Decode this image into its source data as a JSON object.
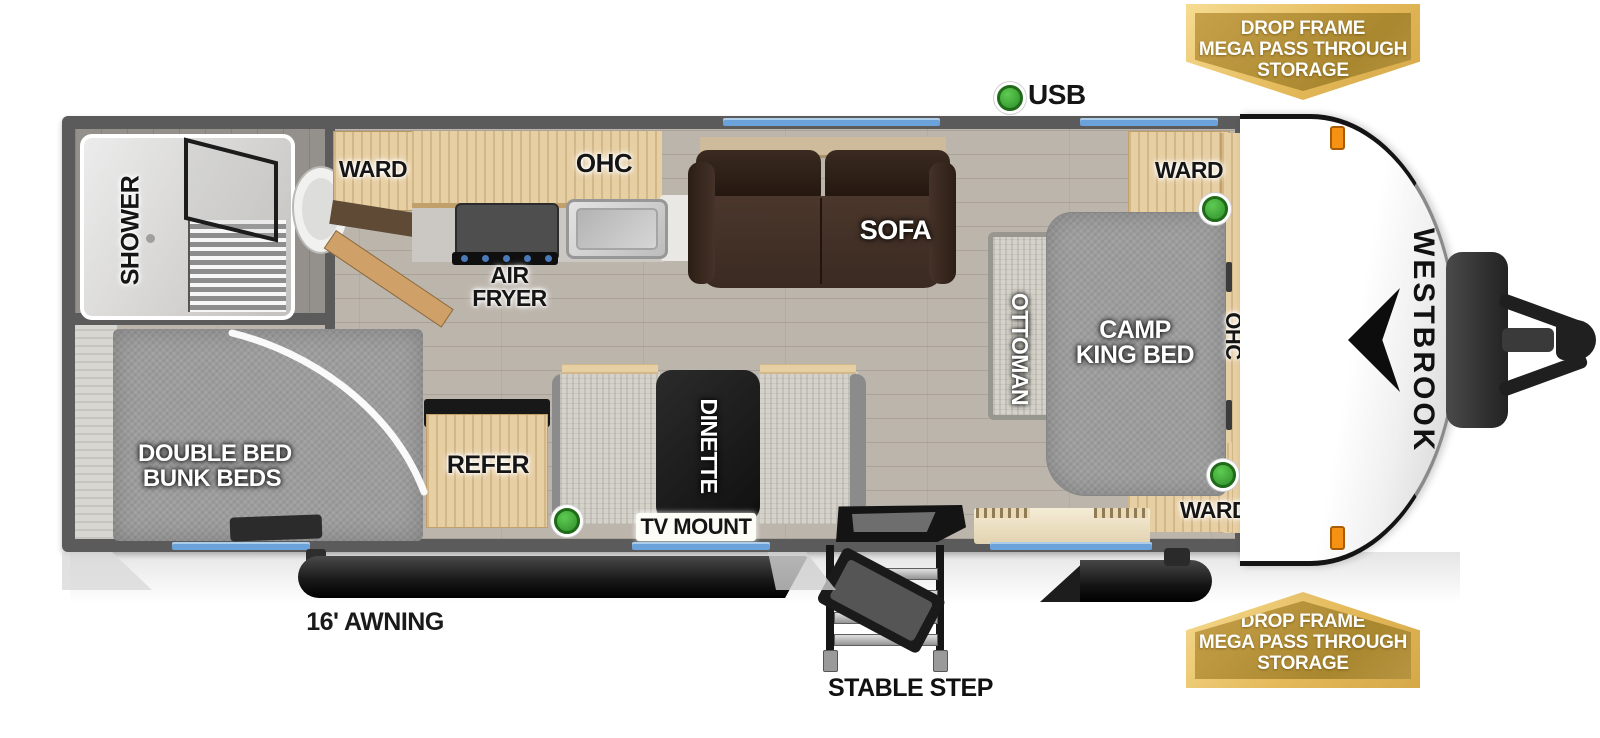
{
  "title": "Westbrook travel trailer floor plan",
  "brand": "WESTBROOK",
  "legend": {
    "usb": "USB"
  },
  "badges": {
    "top": [
      "DROP FRAME",
      "MEGA PASS THROUGH",
      "STORAGE"
    ],
    "bottom": [
      "DROP FRAME",
      "MEGA PASS THROUGH",
      "STORAGE"
    ]
  },
  "labels": {
    "shower": "SHOWER",
    "ward_bath": "WARD",
    "ohc_kitchen": "OHC",
    "air_fryer_1": "AIR",
    "air_fryer_2": "FRYER",
    "sofa": "SOFA",
    "ward_front_top": "WARD",
    "ottoman": "OTTOMAN",
    "camp_king_1": "CAMP",
    "camp_king_2": "KING BED",
    "ohc_front": "OHC",
    "ward_front_bottom": "WARD",
    "bunks_1": "DOUBLE BED",
    "bunks_2": "BUNK BEDS",
    "refer": "REFER",
    "dinette": "DINETTE",
    "tv_mount": "TV MOUNT",
    "awning": "16' AWNING",
    "stable_step": "STABLE STEP"
  },
  "colors": {
    "wall": "#5b5b5b",
    "window_blue": "#6ba2d9",
    "usb_green": "#3fae3c",
    "badge_gold_outer": "#ecc76f",
    "badge_gold_inner": "#b4943f",
    "sofa_brown": "#45332a",
    "bed_gray": "#9d9d9d"
  }
}
